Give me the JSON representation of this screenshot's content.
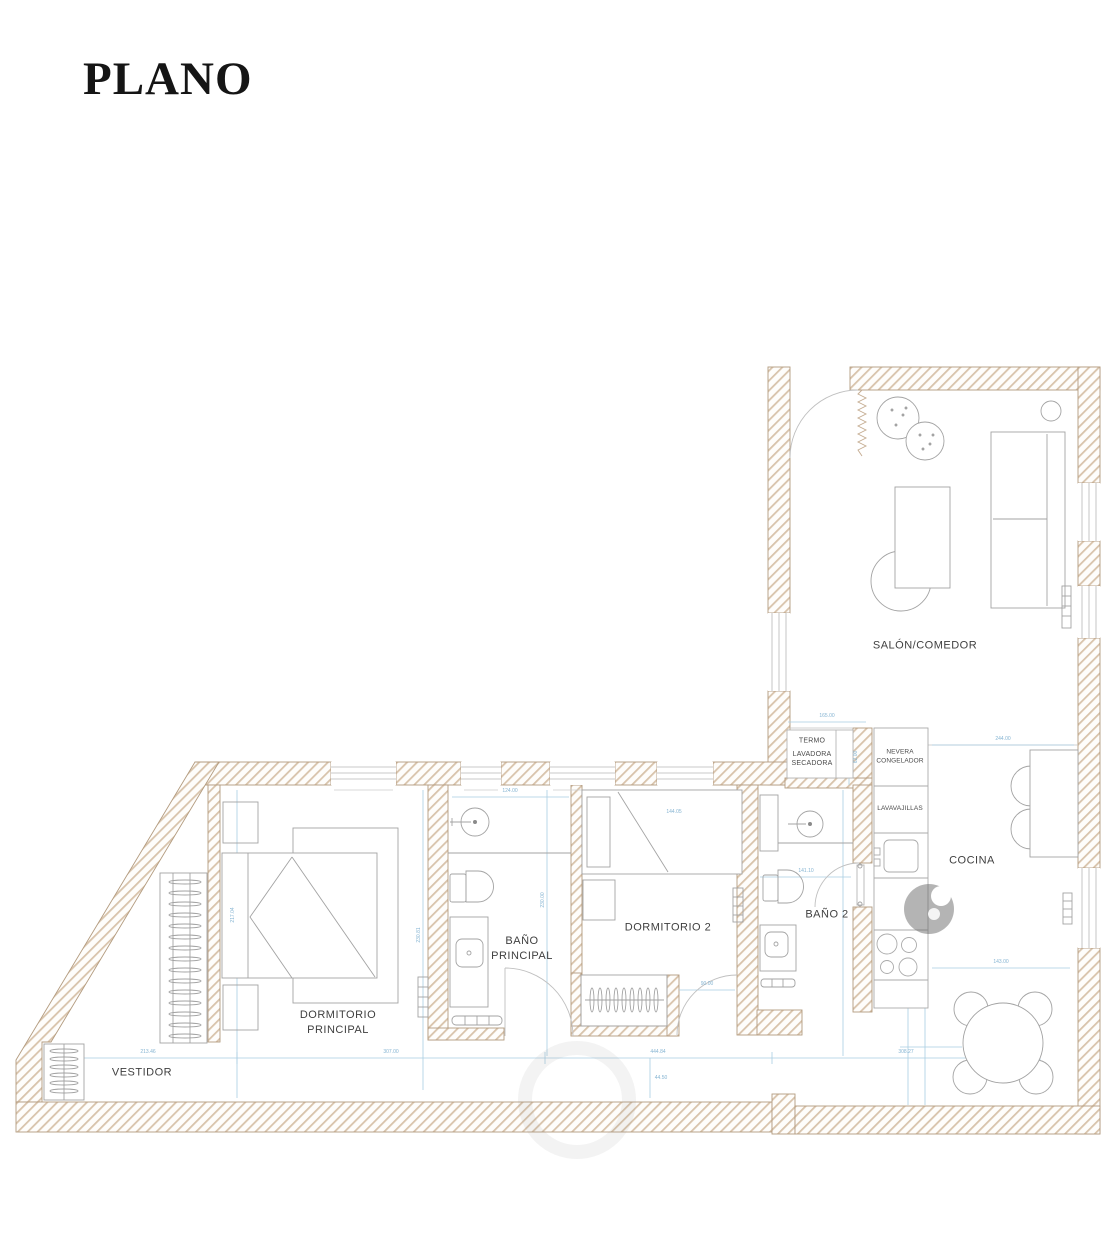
{
  "title": "PLANO",
  "rooms": {
    "salon": "SALÓN/COMEDOR",
    "cocina": "COCINA",
    "bano2": "BAÑO 2",
    "dormitorio2": "DORMITORIO 2",
    "banop_l1": "BAÑO",
    "banop_l2": "PRINCIPAL",
    "dormp_l1": "DORMITORIO",
    "dormp_l2": "PRINCIPAL",
    "vestidor": "VESTIDOR",
    "termo": "TERMO",
    "lavadora_l1": "LAVADORA",
    "lavadora_l2": "SECADORA",
    "nevera_l1": "NEVERA",
    "nevera_l2": "CONGELADOR",
    "lavavajillas": "LAVAVAJILLAS"
  },
  "dims": [
    "213.46",
    "307.00",
    "444.84",
    "308.27",
    "217.04",
    "230.81",
    "230.00",
    "124.00",
    "144.05",
    "165.00",
    "244.00",
    "141.10",
    "143.00",
    "90.00",
    "62.00",
    "44.50"
  ],
  "colors": {
    "wall_hatch": "#d8c3ab",
    "wall_outline": "#b39b7f",
    "furniture_line": "#a3a3a3",
    "dimension_line": "#a9cde2",
    "label_text": "#3f3f3f",
    "watermark_gray": "#6a6a6a"
  }
}
